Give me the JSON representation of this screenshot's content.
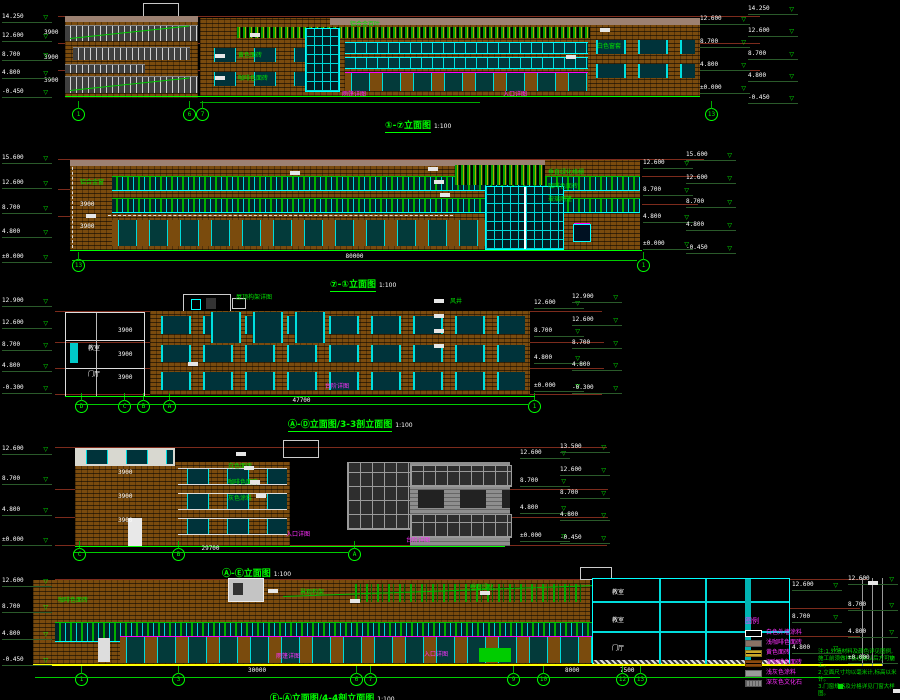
{
  "sheet": {
    "bg": "#000000"
  },
  "captions": {
    "d1": {
      "title": "①-⑦立面图",
      "scale": "1:100"
    },
    "d2": {
      "title": "⑦-①立面图",
      "scale": "1:100"
    },
    "d3": {
      "title": "Ⓐ-Ⓓ立面图/3-3剖立面图",
      "scale": "1:100"
    },
    "d4": {
      "title": "Ⓐ-Ⓔ立面图",
      "scale": "1:100"
    },
    "d5": {
      "title": "Ⓔ-Ⓐ立面图/4-4剖立面图",
      "scale": "1:100"
    }
  },
  "legend": {
    "title": "图例",
    "items": [
      {
        "swatch": "white",
        "label": "白色外墙涂料"
      },
      {
        "swatch": "taupe",
        "label": "浅咖啡色面砖"
      },
      {
        "swatch": "yellow-brick",
        "label": "黄色面砖"
      },
      {
        "swatch": "brown-brick",
        "label": "深咖啡色面砖"
      },
      {
        "swatch": "light-gray",
        "label": "浅灰色涂料"
      },
      {
        "swatch": "dark-gray",
        "label": "深灰色文化石"
      }
    ]
  },
  "notes": {
    "lines": [
      "注:1.外墙材料及颜色详见图例,施工前须做样板经确认后方可施工。",
      "2.立面尺寸均以毫米计,标高以米计。",
      "3.门窗规格及分格详见门窗大样图。"
    ]
  },
  "colors": {
    "brick": "#7a4b0e",
    "taupe": "#9c8172",
    "cyan": "#00ffff",
    "green": "#00ff00",
    "magenta": "#ff00ff",
    "yellow": "#ffff00",
    "maroon": "#7c2b1c",
    "gray": "#8e8e8e"
  },
  "annotations": [
    {
      "t": "黄色面砖",
      "x": 238,
      "y": 53,
      "c": "g"
    },
    {
      "t": "咖啡色面砖",
      "x": 238,
      "y": 76,
      "c": "g"
    },
    {
      "t": "铝合金百叶",
      "x": 350,
      "y": 22,
      "c": "g"
    },
    {
      "t": "白色窗套",
      "x": 597,
      "y": 44,
      "c": "g"
    },
    {
      "t": "雨篷详图",
      "x": 342,
      "y": 92,
      "c": "m"
    },
    {
      "t": "入口详图",
      "x": 503,
      "y": 92,
      "c": "m"
    },
    {
      "t": "3900",
      "x": 44,
      "y": 30,
      "c": "w"
    },
    {
      "t": "3900",
      "x": 44,
      "y": 55,
      "c": "w"
    },
    {
      "t": "3900",
      "x": 44,
      "y": 78,
      "c": "w"
    },
    {
      "t": "垂直绿化格栅",
      "x": 548,
      "y": 170,
      "c": "g"
    },
    {
      "t": "咖啡色面砖",
      "x": 548,
      "y": 184,
      "c": "g"
    },
    {
      "t": "玻璃雨篷",
      "x": 548,
      "y": 197,
      "c": "g"
    },
    {
      "t": "铝合金窗",
      "x": 80,
      "y": 180,
      "c": "g"
    },
    {
      "t": "3900",
      "x": 80,
      "y": 202,
      "c": "w"
    },
    {
      "t": "3900",
      "x": 80,
      "y": 224,
      "c": "w"
    },
    {
      "t": "屋顶构架详图",
      "x": 236,
      "y": 295,
      "c": "g"
    },
    {
      "t": "风井",
      "x": 450,
      "y": 299,
      "c": "g"
    },
    {
      "t": "台阶详图",
      "x": 325,
      "y": 384,
      "c": "m"
    },
    {
      "t": "3900",
      "x": 118,
      "y": 328,
      "c": "w"
    },
    {
      "t": "3900",
      "x": 118,
      "y": 352,
      "c": "w"
    },
    {
      "t": "3900",
      "x": 118,
      "y": 375,
      "c": "w"
    },
    {
      "t": "教室",
      "x": 88,
      "y": 346,
      "c": "w"
    },
    {
      "t": "门厅",
      "x": 88,
      "y": 372,
      "c": "w"
    },
    {
      "t": "白色面砖",
      "x": 228,
      "y": 464,
      "c": "g"
    },
    {
      "t": "咖啡色面砖",
      "x": 228,
      "y": 480,
      "c": "g"
    },
    {
      "t": "灰色涂料",
      "x": 228,
      "y": 496,
      "c": "g"
    },
    {
      "t": "入口详图",
      "x": 286,
      "y": 532,
      "c": "m"
    },
    {
      "t": "台阶详图",
      "x": 406,
      "y": 538,
      "c": "m"
    },
    {
      "t": "3900",
      "x": 118,
      "y": 470,
      "c": "w"
    },
    {
      "t": "3900",
      "x": 118,
      "y": 494,
      "c": "w"
    },
    {
      "t": "3900",
      "x": 118,
      "y": 518,
      "c": "w"
    },
    {
      "t": "垂直绿化",
      "x": 470,
      "y": 585,
      "c": "g"
    },
    {
      "t": "景观构架",
      "x": 300,
      "y": 590,
      "c": "g"
    },
    {
      "t": "咖啡色面砖",
      "x": 58,
      "y": 598,
      "c": "g"
    },
    {
      "t": "入口详图",
      "x": 424,
      "y": 652,
      "c": "m"
    },
    {
      "t": "雨篷详图",
      "x": 276,
      "y": 654,
      "c": "m"
    },
    {
      "t": "30000",
      "x": 248,
      "y": 668,
      "c": "w"
    },
    {
      "t": "8000",
      "x": 565,
      "y": 668,
      "c": "w"
    },
    {
      "t": "7500",
      "x": 620,
      "y": 668,
      "c": "w"
    },
    {
      "t": "教室",
      "x": 612,
      "y": 590,
      "c": "w"
    },
    {
      "t": "教室",
      "x": 612,
      "y": 618,
      "c": "w"
    },
    {
      "t": "门厅",
      "x": 612,
      "y": 646,
      "c": "w"
    }
  ],
  "level_columns": [
    {
      "x": 2,
      "y": 14,
      "h": 84,
      "e": [
        "14.250",
        "12.600",
        "8.700",
        "4.800",
        "-0.450"
      ]
    },
    {
      "x": 700,
      "y": 16,
      "h": 78,
      "e": [
        "12.600",
        "8.700",
        "4.800",
        "±0.000"
      ]
    },
    {
      "x": 748,
      "y": 6,
      "h": 98,
      "e": [
        "14.250",
        "12.600",
        "8.700",
        "4.800",
        "-0.450"
      ]
    },
    {
      "x": 2,
      "y": 155,
      "h": 108,
      "e": [
        "15.600",
        "12.600",
        "8.700",
        "4.800",
        "±0.000"
      ]
    },
    {
      "x": 643,
      "y": 160,
      "h": 90,
      "e": [
        "12.600",
        "8.700",
        "4.800",
        "±0.000"
      ]
    },
    {
      "x": 686,
      "y": 152,
      "h": 102,
      "e": [
        "15.600",
        "12.600",
        "8.700",
        "4.800",
        "-0.450"
      ]
    },
    {
      "x": 2,
      "y": 298,
      "h": 96,
      "e": [
        "12.900",
        "12.600",
        "8.700",
        "4.800",
        "-0.300"
      ]
    },
    {
      "x": 534,
      "y": 300,
      "h": 92,
      "e": [
        "12.600",
        "8.700",
        "4.800",
        "±0.000"
      ]
    },
    {
      "x": 572,
      "y": 294,
      "h": 100,
      "e": [
        "12.900",
        "12.600",
        "8.700",
        "4.800",
        "-0.300"
      ]
    },
    {
      "x": 2,
      "y": 446,
      "h": 100,
      "e": [
        "12.600",
        "8.700",
        "4.800",
        "±0.000"
      ]
    },
    {
      "x": 520,
      "y": 450,
      "h": 92,
      "e": [
        "12.600",
        "8.700",
        "4.800",
        "±0.000"
      ]
    },
    {
      "x": 560,
      "y": 444,
      "h": 100,
      "e": [
        "13.500",
        "12.600",
        "8.700",
        "4.800",
        "-0.450"
      ]
    },
    {
      "x": 2,
      "y": 578,
      "h": 88,
      "e": [
        "12.600",
        "8.700",
        "4.800",
        "-0.450"
      ]
    },
    {
      "x": 792,
      "y": 582,
      "h": 72,
      "e": [
        "12.600",
        "8.700",
        "4.800"
      ]
    },
    {
      "x": 848,
      "y": 576,
      "h": 88,
      "e": [
        "12.600",
        "8.700",
        "4.800",
        "±0.000"
      ]
    }
  ],
  "grid_bubbles": [
    {
      "l": "1",
      "x": 72,
      "y": 108
    },
    {
      "l": "6",
      "x": 183,
      "y": 108
    },
    {
      "l": "7",
      "x": 196,
      "y": 108
    },
    {
      "l": "13",
      "x": 705,
      "y": 108
    },
    {
      "l": "13",
      "x": 72,
      "y": 259
    },
    {
      "l": "1",
      "x": 637,
      "y": 259
    },
    {
      "l": "D",
      "x": 75,
      "y": 400
    },
    {
      "l": "C",
      "x": 118,
      "y": 400
    },
    {
      "l": "B",
      "x": 137,
      "y": 400
    },
    {
      "l": "A",
      "x": 163,
      "y": 400
    },
    {
      "l": "1",
      "x": 528,
      "y": 400
    },
    {
      "l": "C",
      "x": 73,
      "y": 548
    },
    {
      "l": "B",
      "x": 172,
      "y": 548
    },
    {
      "l": "A",
      "x": 348,
      "y": 548
    },
    {
      "l": "1",
      "x": 75,
      "y": 673
    },
    {
      "l": "3",
      "x": 172,
      "y": 673
    },
    {
      "l": "6",
      "x": 350,
      "y": 673
    },
    {
      "l": "7",
      "x": 364,
      "y": 673
    },
    {
      "l": "9",
      "x": 507,
      "y": 673
    },
    {
      "l": "10",
      "x": 537,
      "y": 673
    },
    {
      "l": "12",
      "x": 616,
      "y": 673
    },
    {
      "l": "13",
      "x": 634,
      "y": 673
    }
  ],
  "dim_lines": [
    {
      "x": 65,
      "y": 96,
      "w": 635,
      "c": "#00ff00"
    },
    {
      "x": 200,
      "y": 102,
      "w": 280,
      "c": "#00aa00"
    },
    {
      "x": 70,
      "y": 250,
      "w": 572,
      "c": "#00ff00"
    },
    {
      "x": 72,
      "y": 260,
      "w": 565,
      "c": "#00cc00",
      "label": "80000"
    },
    {
      "x": 65,
      "y": 396,
      "w": 470,
      "c": "#00ff00"
    },
    {
      "x": 75,
      "y": 404,
      "w": 453,
      "c": "#00cc00",
      "label": "47700"
    },
    {
      "x": 75,
      "y": 546,
      "w": 430,
      "c": "#00ff00"
    },
    {
      "x": 73,
      "y": 552,
      "w": 275,
      "c": "#00cc00",
      "label": "29700"
    },
    {
      "x": 35,
      "y": 677,
      "w": 805,
      "c": "#00cc00"
    }
  ],
  "white_tags": [
    [
      215,
      54
    ],
    [
      215,
      76
    ],
    [
      250,
      33
    ],
    [
      600,
      28
    ],
    [
      566,
      55
    ],
    [
      290,
      171
    ],
    [
      428,
      167
    ],
    [
      434,
      180
    ],
    [
      440,
      193
    ],
    [
      86,
      214
    ],
    [
      434,
      299
    ],
    [
      434,
      314
    ],
    [
      434,
      329
    ],
    [
      434,
      344
    ],
    [
      188,
      362
    ],
    [
      236,
      452
    ],
    [
      244,
      466
    ],
    [
      250,
      480
    ],
    [
      256,
      494
    ],
    [
      268,
      589
    ],
    [
      350,
      599
    ],
    [
      480,
      591
    ],
    [
      868,
      581
    ],
    [
      893,
      689
    ]
  ]
}
